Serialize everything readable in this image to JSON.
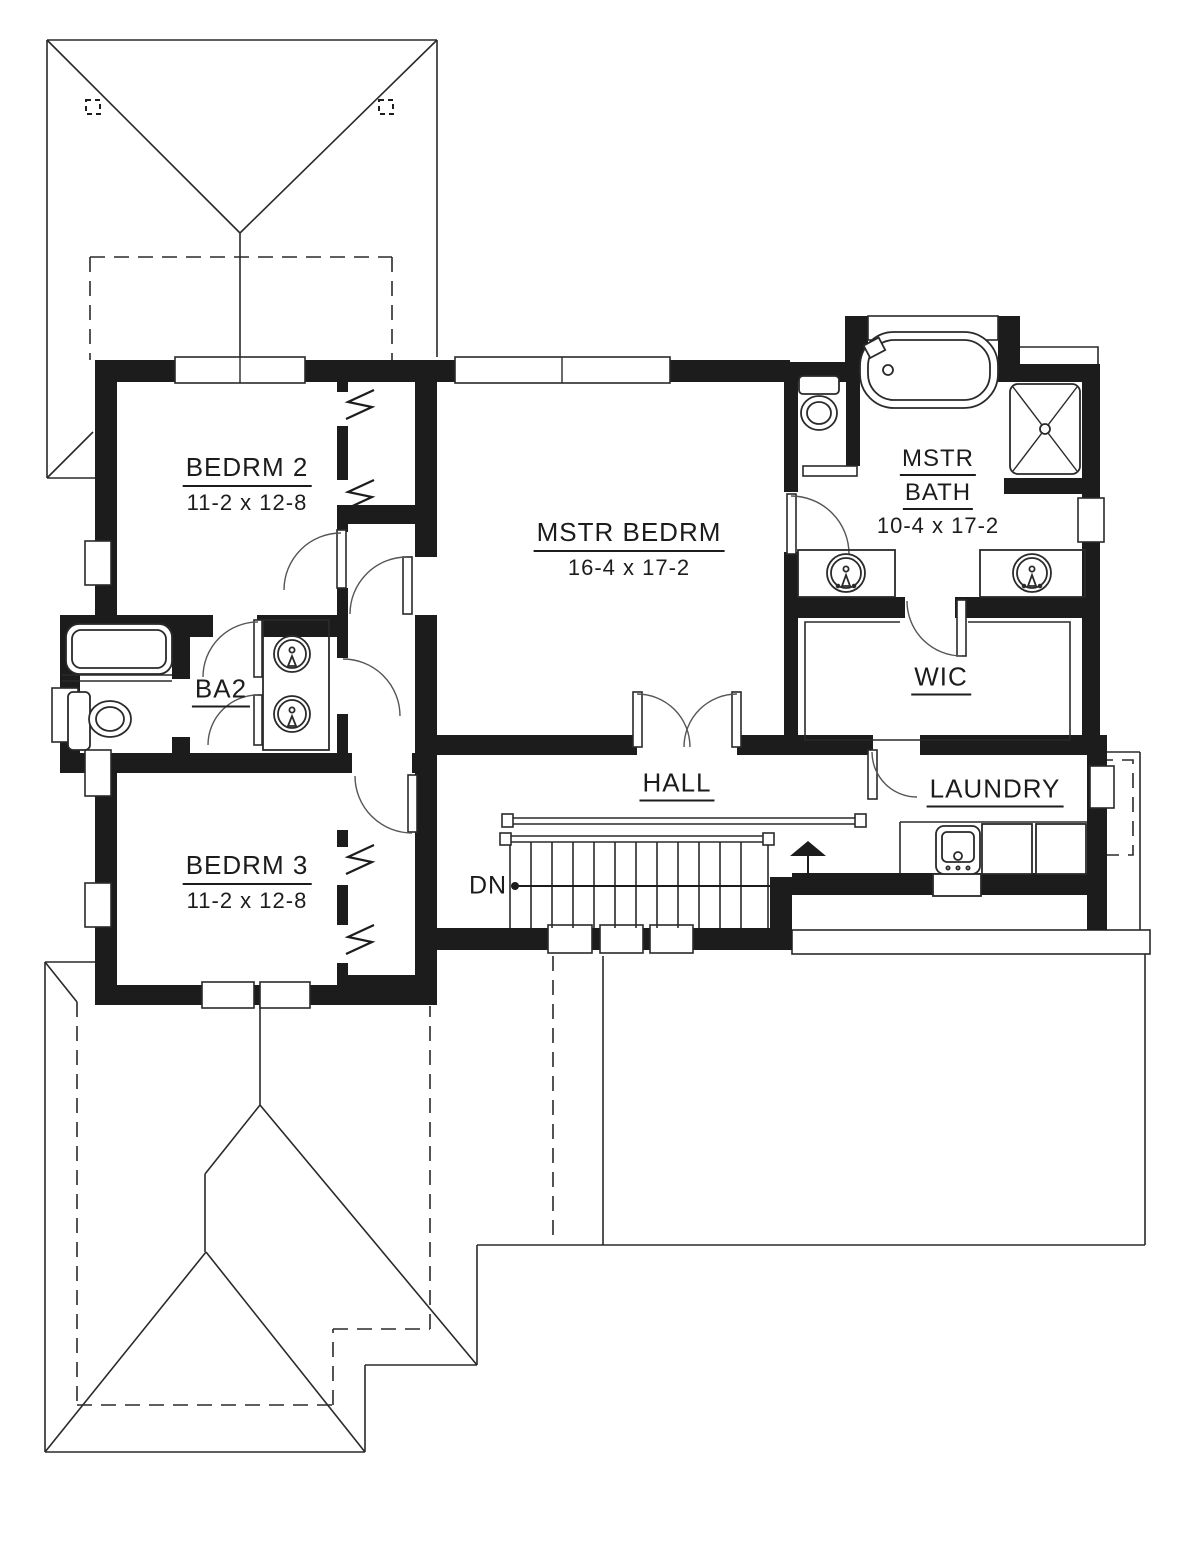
{
  "plan": {
    "title": "Second floor plan",
    "colors": {
      "ink": "#1c1c1c",
      "background": "#ffffff"
    },
    "rooms": [
      {
        "id": "bedrm2",
        "name": "BEDRM 2",
        "dims": "11-2 x 12-8"
      },
      {
        "id": "mstr_bedrm",
        "name": "MSTR BEDRM",
        "dims": "16-4 x 17-2"
      },
      {
        "id": "mstr_bath",
        "name_line1": "MSTR",
        "name_line2": "BATH",
        "dims": "10-4 x 17-2"
      },
      {
        "id": "ba2",
        "name": "BA2"
      },
      {
        "id": "wic",
        "name": "WIC"
      },
      {
        "id": "bedrm3",
        "name": "BEDRM 3",
        "dims": "11-2 x 12-8"
      },
      {
        "id": "hall",
        "name": "HALL"
      },
      {
        "id": "laundry",
        "name": "LAUNDRY"
      }
    ],
    "stairs": {
      "direction_label": "DN"
    },
    "fixtures": [
      "bathtub",
      "toilet",
      "sink",
      "shower",
      "double-vanity",
      "washer",
      "dryer",
      "laundry-sink",
      "closet-pivot-doors"
    ]
  }
}
